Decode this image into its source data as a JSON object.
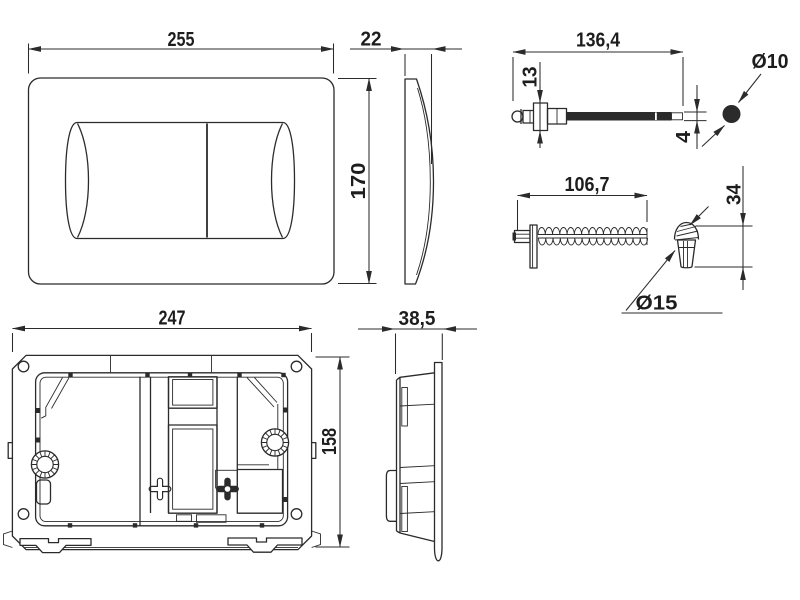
{
  "drawing": {
    "background": "#ffffff",
    "line_color": "#2b2b2b",
    "labels": {
      "plate_width": "255",
      "plate_depth": "22",
      "plate_height": "170",
      "rod_length": "136,4",
      "rod_head_height": "13",
      "rod_tip_diameter": "4",
      "rod_diameter": "Ø10",
      "spring_length": "106,7",
      "cone_height": "34",
      "cone_diameter": "Ø15",
      "frame_width": "247",
      "frame_height": "158",
      "frame_depth": "38,5"
    }
  }
}
